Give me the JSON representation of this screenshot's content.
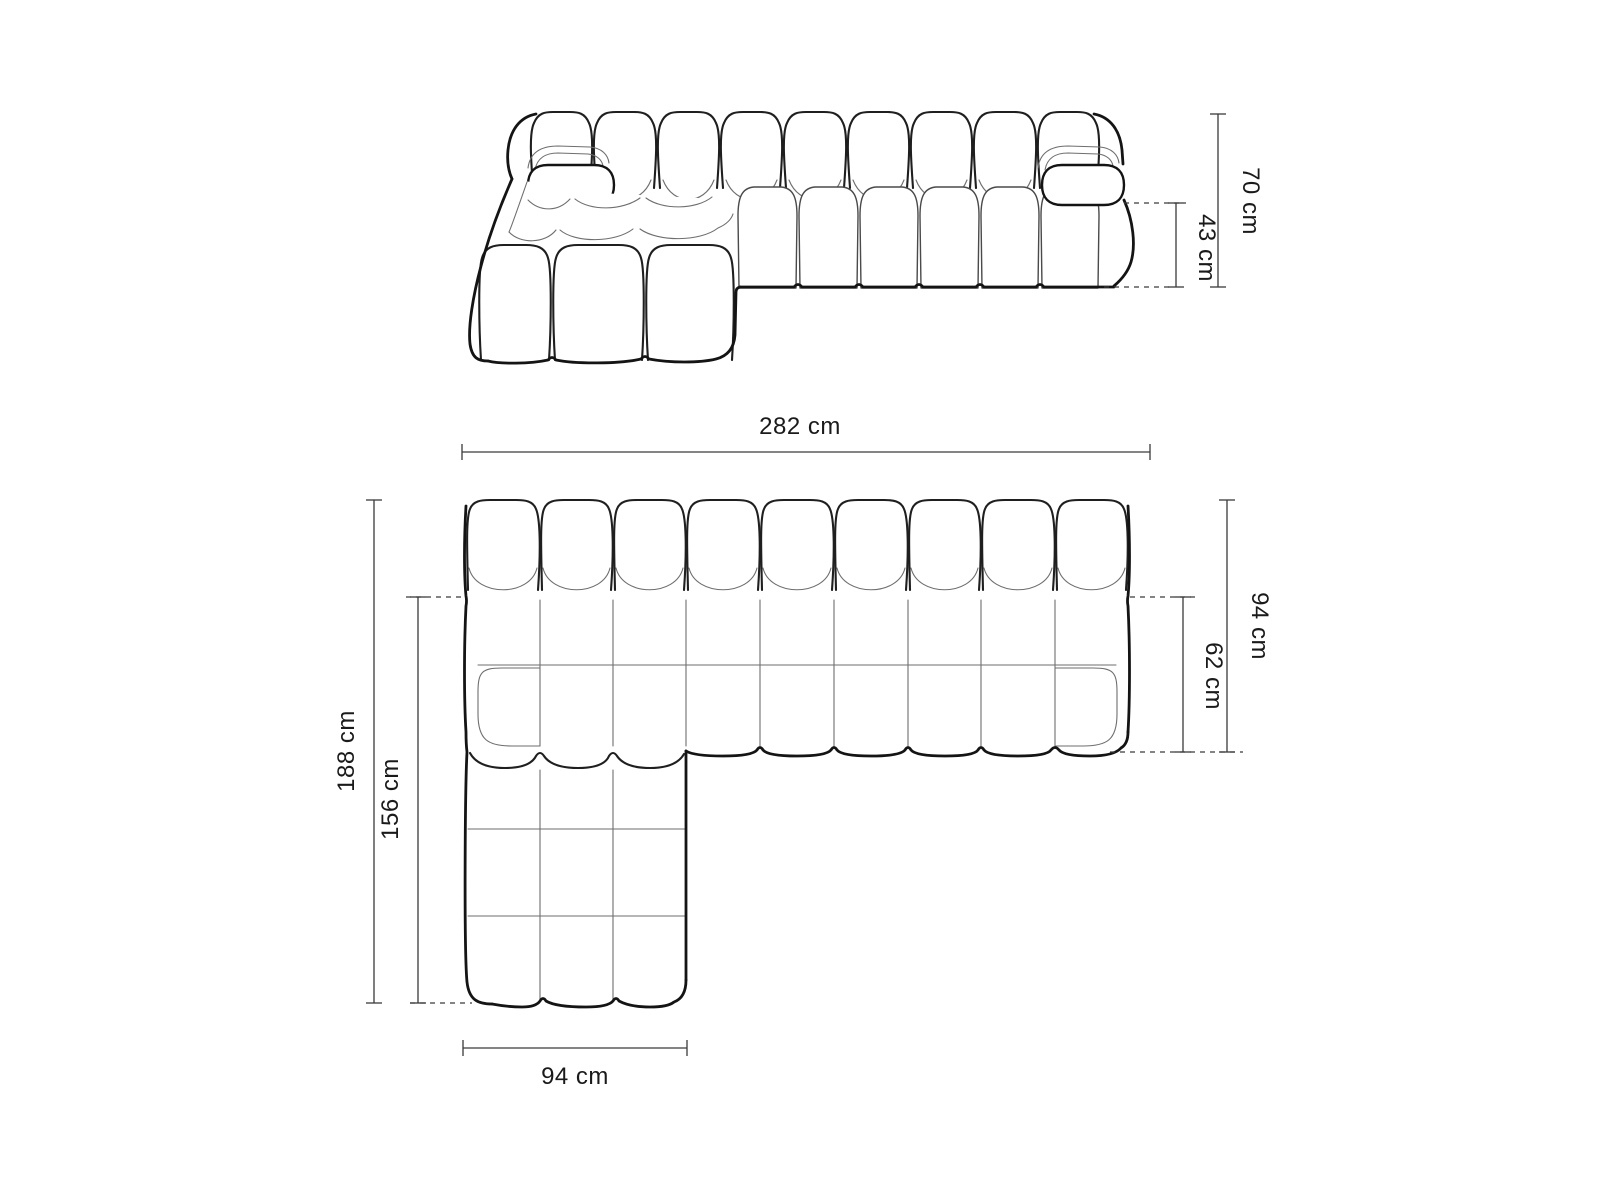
{
  "diagram": {
    "type": "furniture-dimension-drawing",
    "subject": "modular bubble-tufted corner sofa with left chaise longue",
    "views": [
      {
        "id": "front-elevation",
        "dimensions": [
          "70 cm",
          "43 cm"
        ]
      },
      {
        "id": "top-plan",
        "dimensions": [
          "282 cm",
          "94 cm",
          "62 cm",
          "188 cm",
          "156 cm",
          "94 cm"
        ]
      }
    ],
    "back_cushion_count": 9,
    "chaise_column_count": 3,
    "colors": {
      "background": "#ffffff",
      "outline": "#141414",
      "seam": "#6e6e6e",
      "dimension_line": "#3a3a3a",
      "label_text": "#1a1a1a"
    }
  },
  "dims": {
    "front_total_height": "70 cm",
    "front_seat_height": "43 cm",
    "plan_total_width": "282 cm",
    "plan_total_depth": "94 cm",
    "plan_seat_depth": "62 cm",
    "plan_total_length": "188 cm",
    "plan_chaise_length": "156 cm",
    "plan_chaise_width": "94 cm"
  }
}
